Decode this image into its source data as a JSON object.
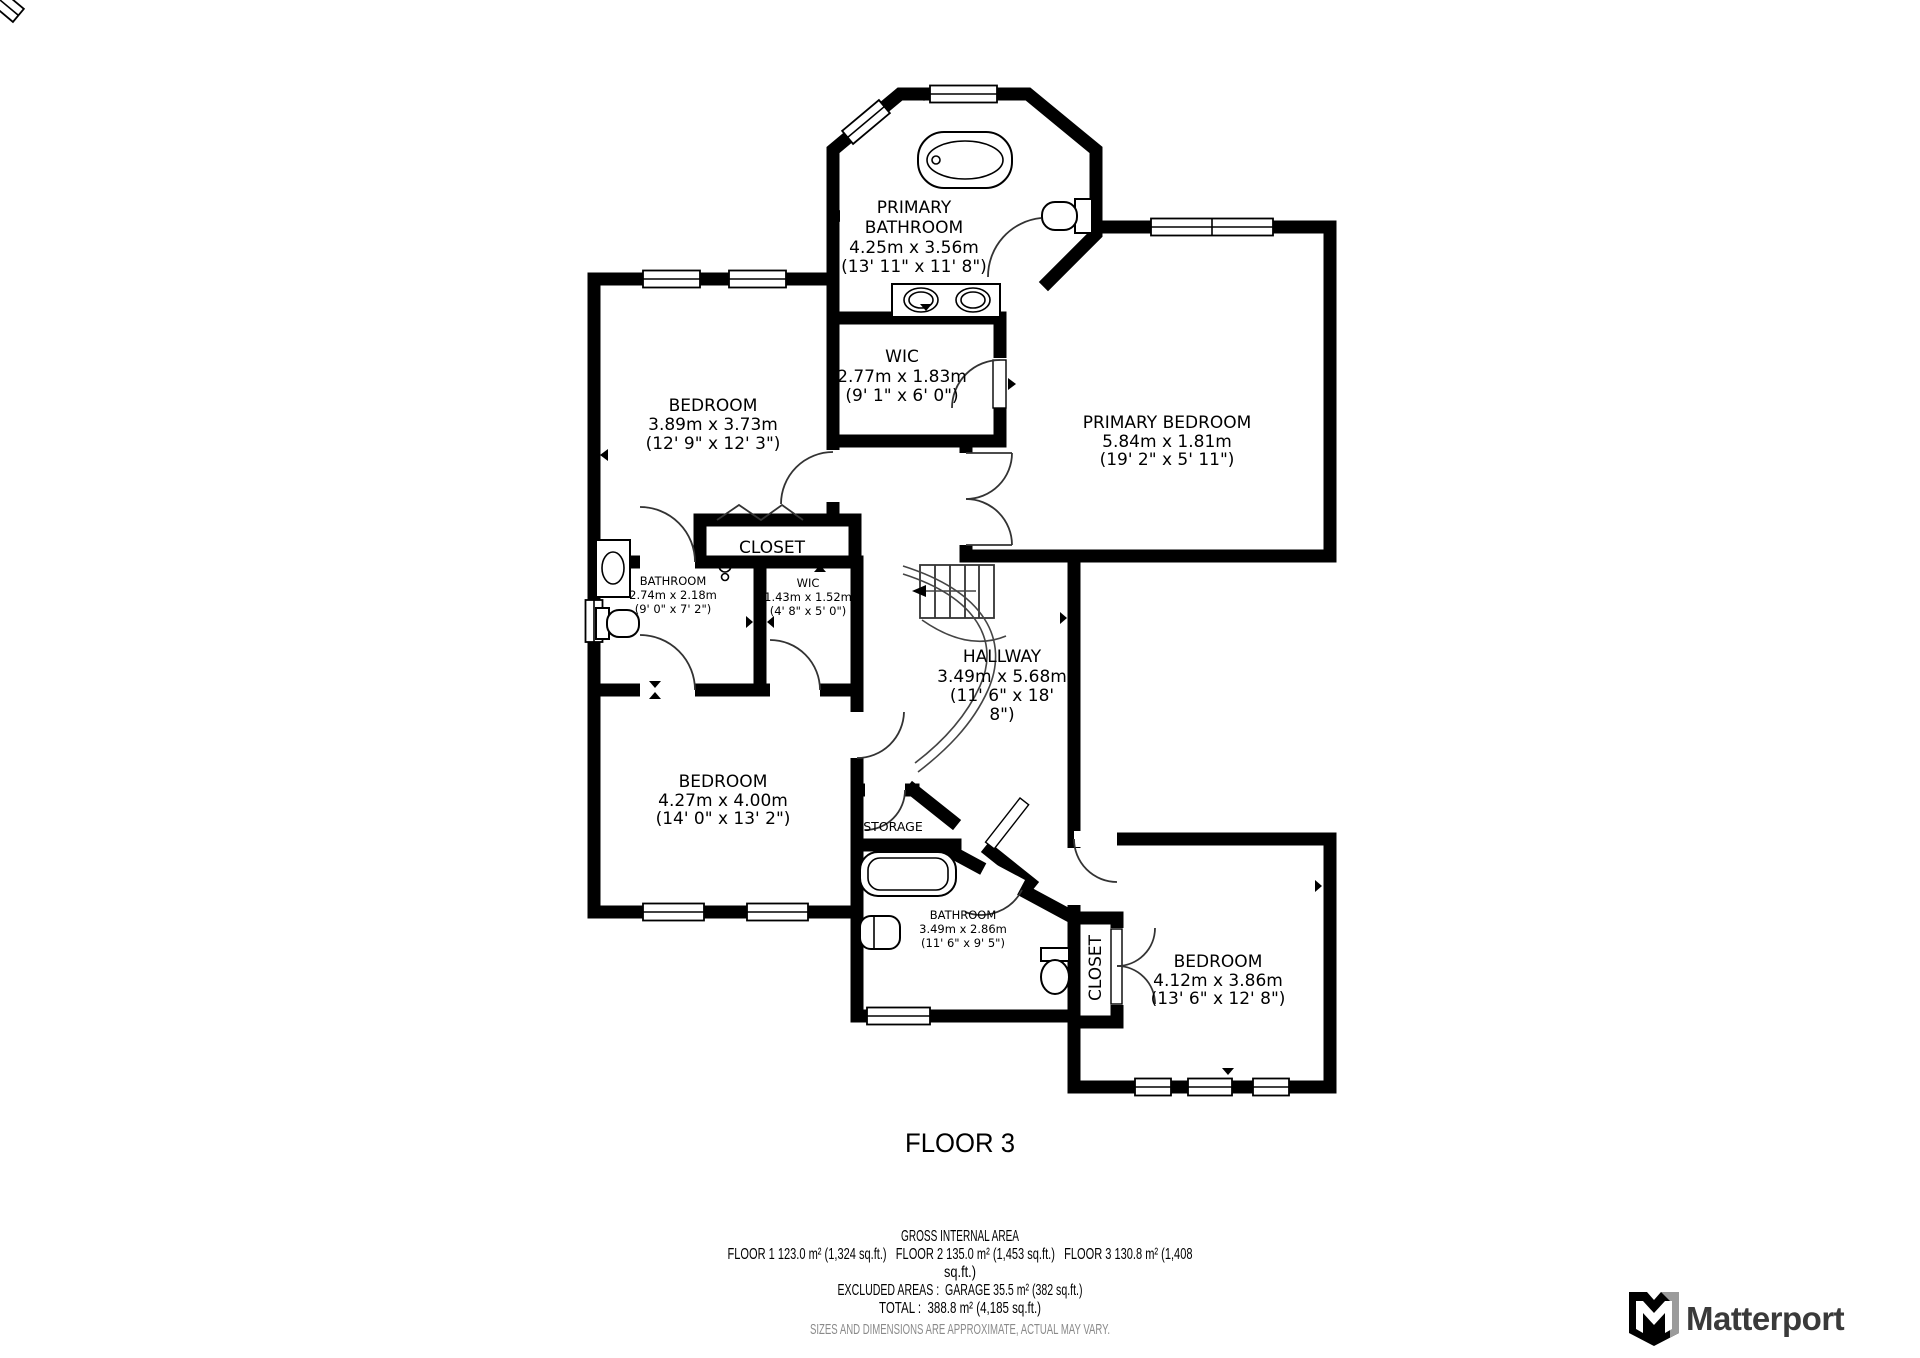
{
  "floor_title": "FLOOR 3",
  "rooms": [
    {
      "id": "primary-bathroom",
      "lines": [
        "PRIMARY",
        "BATHROOM",
        "4.25m x 3.56m",
        "(13' 11\" x 11' 8\")"
      ]
    },
    {
      "id": "wic-primary",
      "lines": [
        "WIC",
        "2.77m x 1.83m",
        "(9' 1\" x 6' 0\")"
      ]
    },
    {
      "id": "bedroom-top-left",
      "lines": [
        "BEDROOM",
        "3.89m x 3.73m",
        "(12' 9\" x 12' 3\")"
      ]
    },
    {
      "id": "primary-bedroom",
      "lines": [
        "PRIMARY BEDROOM",
        "5.84m x 1.81m",
        "(19' 2\" x 5' 11\")"
      ]
    },
    {
      "id": "closet-main",
      "lines": [
        "CLOSET"
      ]
    },
    {
      "id": "bathroom-small",
      "lines": [
        "BATHROOM",
        "2.74m x 2.18m",
        "(9' 0\" x 7' 2\")"
      ]
    },
    {
      "id": "wic-small",
      "lines": [
        "WIC",
        "1.43m x 1.52m",
        "(4' 8\" x 5' 0\")"
      ]
    },
    {
      "id": "hallway",
      "lines": [
        "HALLWAY",
        "3.49m x 5.68m",
        "(11' 6\" x 18'",
        "8\")"
      ]
    },
    {
      "id": "bedroom-middle",
      "lines": [
        "BEDROOM",
        "4.27m x 4.00m",
        "(14' 0\" x 13' 2\")"
      ]
    },
    {
      "id": "storage",
      "lines": [
        "STORAGE"
      ]
    },
    {
      "id": "bathroom-bottom",
      "lines": [
        "BATHROOM",
        "3.49m x 2.86m",
        "(11' 6\" x 9' 5\")"
      ]
    },
    {
      "id": "closet-bedroom",
      "lines": [
        "CLOSET"
      ]
    },
    {
      "id": "bedroom-bottom-right",
      "lines": [
        "BEDROOM",
        "4.12m x 3.86m",
        "(13' 6\" x 12' 8\")"
      ]
    }
  ],
  "footer": {
    "line1": "GROSS INTERNAL AREA",
    "line2": "FLOOR 1 123.0 m² (1,324 sq.ft.)   FLOOR 2 135.0 m² (1,453 sq.ft.)   FLOOR 3 130.8 m² (1,408",
    "line3": "sq.ft.)",
    "line4": "EXCLUDED AREAS :  GARAGE 35.5 m² (382 sq.ft.)",
    "line5": "TOTAL :  388.8 m² (4,185 sq.ft.)",
    "disclaimer": "SIZES AND DIMENSIONS ARE APPROXIMATE, ACTUAL MAY VARY."
  },
  "branding": {
    "logo_text": "Matterport",
    "logo_icon": "matterport-m-icon"
  },
  "colors": {
    "walls": "#000000",
    "text": "#000000",
    "disclaimer": "#8a8a8a",
    "logo_text": "#3a3a3a",
    "logo_gray": "#9b9b9b",
    "background": "#ffffff"
  }
}
